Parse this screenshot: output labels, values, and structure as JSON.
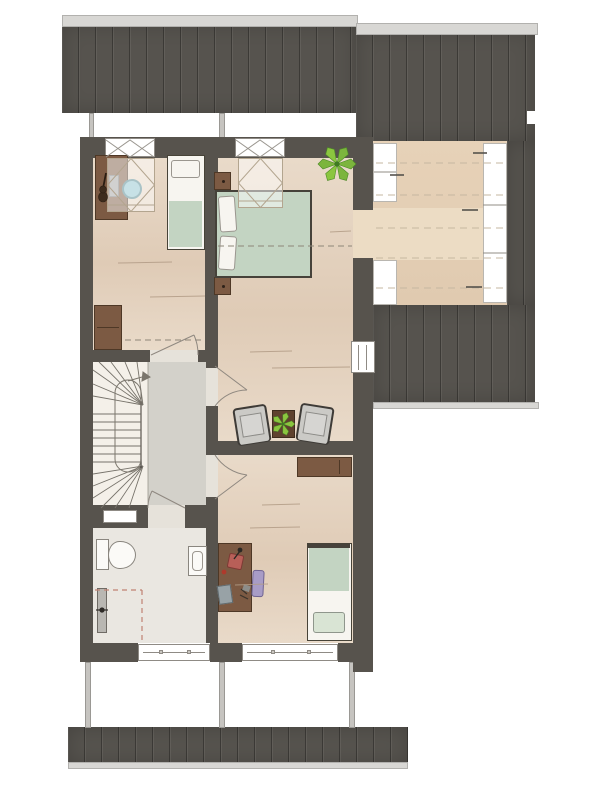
{
  "plan": {
    "type": "floor-plan",
    "storey": "attic",
    "rooms": [
      {
        "name": "bedroom-top-left",
        "floor": "wood"
      },
      {
        "name": "master-bedroom",
        "floor": "wood"
      },
      {
        "name": "roof-terrace",
        "floor": "deck"
      },
      {
        "name": "hallway-landing",
        "floor": "gray"
      },
      {
        "name": "staircase",
        "floor": "cream"
      },
      {
        "name": "bathroom",
        "floor": "tile"
      },
      {
        "name": "bedroom-bottom",
        "floor": "wood"
      }
    ],
    "furniture": [
      "desk-with-guitar-and-stool",
      "single-bed-1",
      "dresser",
      "double-bed",
      "nightstand-1",
      "nightstand-2",
      "potted-plant-large",
      "armchair-1",
      "armchair-2",
      "side-table-with-plant",
      "sideboard",
      "desk-with-lamp-laptop-chair",
      "single-bed-2",
      "toilet",
      "washbasin",
      "radiator",
      "winder-stair-with-up-arrow"
    ],
    "features": [
      "top-roof",
      "right-roof",
      "bottom-roof",
      "eaves-strips",
      "dormer-windows",
      "skylight-floor-projections",
      "ceiling-height-dashed-lines",
      "terrace-glazing",
      "door-swing-arcs",
      "facade-windows",
      "support-posts"
    ]
  },
  "palette": {
    "roof_dark": "#56534e",
    "ridge_light": "#d8d7d4",
    "wall_dark": "#57534d",
    "wood_light": "#e9dac9",
    "wood_mid": "#dfcbb6",
    "deck_tan": "#e0cab0",
    "landing_gray": "#d3d1ca",
    "stair_cream": "#f4f0e9",
    "bath_floor": "#eae7e1",
    "window_white": "#ffffff",
    "frame_gray": "#8f8b85",
    "duvet_sage": "#c3d4c2",
    "pillow_white": "#f7f5f0",
    "furniture_brown": "#7c5a43",
    "furniture_brown_dark": "#4e3826",
    "chair_gray": "#cbcac6",
    "chair_border": "#3e3b37",
    "stool_teal": "#8fc2cc",
    "plant_green": "#7cb53d",
    "plant_green_bright": "#8bc63f",
    "plant_dark": "#3f7a22",
    "accent_chair_purple": "#a89cc6",
    "lamp_red": "#b85f58",
    "laptop_gray": "#98a2a6",
    "radiator_gray": "#b9b7b2",
    "dash_brown": "#8e8678",
    "dash_pink": "#c08273",
    "post_gray": "#c6c4c0"
  }
}
